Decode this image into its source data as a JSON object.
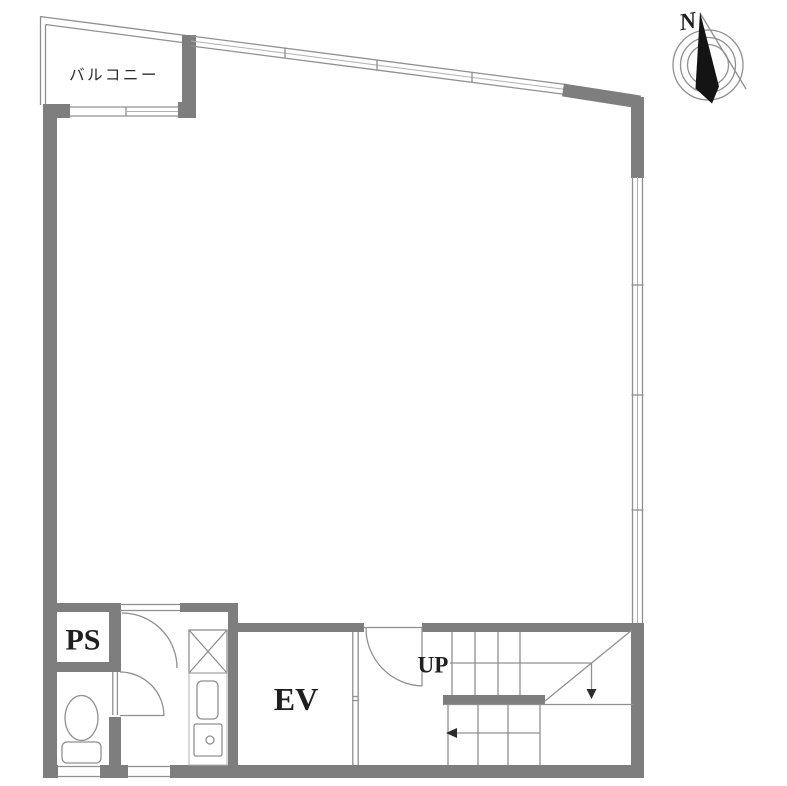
{
  "title": "Building floor plan",
  "colors": {
    "wall": "#7e7e7e",
    "line": "#909090",
    "line_light": "#b0b0b0",
    "text": "#1f1f1f",
    "needle": "#141414",
    "bg": "#ffffff"
  },
  "labels": {
    "balcony": "バルコニー",
    "pipe_shaft": "PS",
    "elevator": "EV",
    "stairs_up": "UP",
    "compass_north": "N"
  },
  "rooms": [
    {
      "name": "balcony",
      "label": "バルコニー"
    },
    {
      "name": "main-room",
      "label": ""
    },
    {
      "name": "pipe-shaft",
      "label": "PS"
    },
    {
      "name": "toilet",
      "label": ""
    },
    {
      "name": "elevator",
      "label": "EV"
    },
    {
      "name": "staircase",
      "label": "UP"
    }
  ]
}
